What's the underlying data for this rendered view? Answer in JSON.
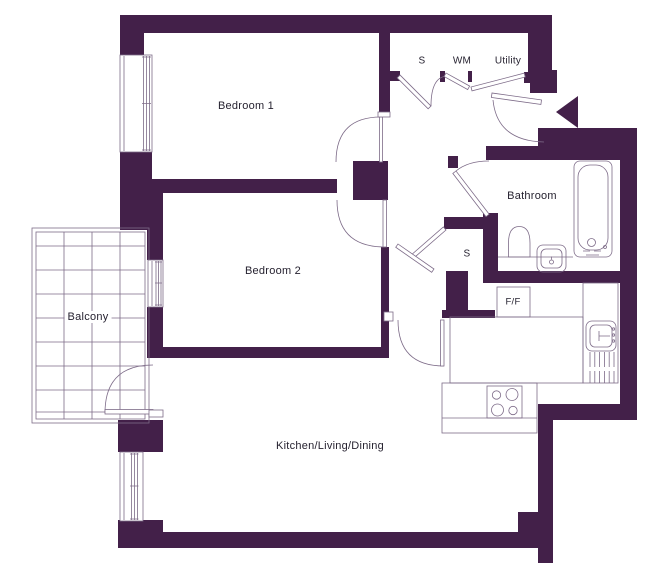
{
  "title": "Apartment floor plan",
  "colors": {
    "wall": "#432049",
    "line": "#7d6b88",
    "text": "#262230",
    "bg": "#ffffff"
  },
  "rooms": {
    "bedroom1": "Bedroom 1",
    "bedroom2": "Bedroom 2",
    "bathroom": "Bathroom",
    "kitchen_living_dining": "Kitchen/Living/Dining",
    "balcony": "Balcony",
    "store_hall": "S",
    "washing_machine": "WM",
    "utility": "Utility",
    "store_inner": "S",
    "fridge_freezer": "F/F"
  },
  "icons": {
    "entry_arrow": "left-pointing-triangle marking flat entrance"
  }
}
